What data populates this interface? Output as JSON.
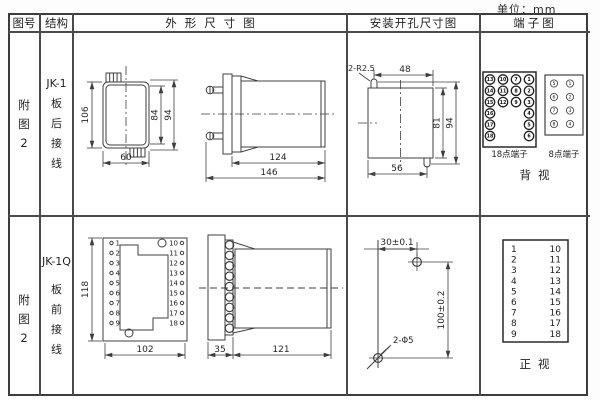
{
  "unit_label": "单位：mm",
  "table": {
    "headers": {
      "fig_no": "图号",
      "structure": "结构",
      "outline": "外形尺寸图",
      "mounting": "安装开孔尺寸图",
      "terminal": "端子图"
    }
  },
  "row1": {
    "fig_no": [
      "附",
      "图",
      "2"
    ],
    "structure": [
      "JK-1",
      "板",
      "后",
      "接",
      "线"
    ],
    "outline_dims": {
      "height": "106",
      "inner_height": "84",
      "stud_span": "94",
      "width": "60",
      "body_len": "124",
      "total_len": "146"
    },
    "mounting_dims": {
      "slot": "2-R2.5",
      "top_w": "48",
      "inner_h": "81",
      "outer_h": "94",
      "bottom_w": "56"
    },
    "terminals18": {
      "label": "18点端子",
      "cells": [
        "13",
        "10",
        "7",
        "1",
        "14",
        "11",
        "8",
        "2",
        "15",
        "12",
        "9",
        "3",
        "16",
        "4",
        "17",
        "5",
        "18",
        "6"
      ]
    },
    "terminals8": {
      "label": "8点端子",
      "cells": [
        "5",
        "1",
        "6",
        "2",
        "7",
        "3",
        "8",
        "4"
      ]
    },
    "view_label": "背视"
  },
  "row2": {
    "fig_no": [
      "附",
      "图",
      "2"
    ],
    "structure": [
      "JK-1Q",
      "板",
      "前",
      "接",
      "线"
    ],
    "outline_dims": {
      "height": "118",
      "width": "102",
      "flange": "35",
      "body_len": "121"
    },
    "left_terminals": [
      "1",
      "2",
      "3",
      "4",
      "5",
      "6",
      "7",
      "8",
      "9"
    ],
    "right_terminals": [
      "10",
      "11",
      "12",
      "13",
      "14",
      "15",
      "16",
      "17",
      "18"
    ],
    "mounting_dims": {
      "h_dist": "30±0.1",
      "v_dist": "100±0.2",
      "holes": "2-Φ5"
    },
    "view_label": "正视"
  }
}
